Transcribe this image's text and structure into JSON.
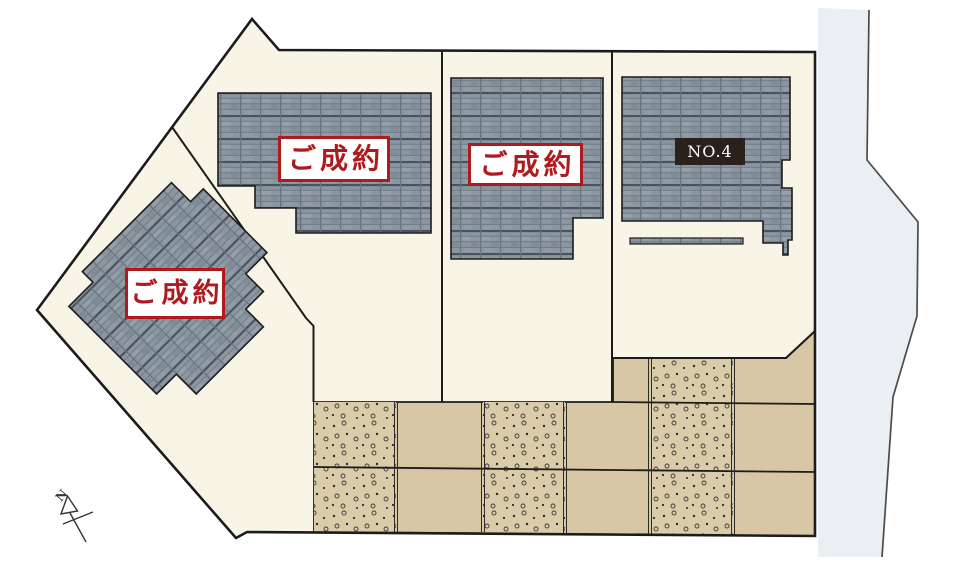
{
  "site_plan": {
    "lots": [
      {
        "id": "lot-1",
        "label": "ご成約"
      },
      {
        "id": "lot-2",
        "label": "ご成約"
      },
      {
        "id": "lot-3",
        "label": "ご成約"
      },
      {
        "id": "lot-4",
        "label": "NO.4"
      }
    ],
    "compass": {
      "label": "N"
    },
    "colors": {
      "site_fill": "#F8F5E6",
      "roof_gray": "#8B96A1",
      "parking_tan": "#D7C7A4",
      "stall_stipple_tan": "#DACBA9",
      "road_gray": "#EAEFF4",
      "accent_red": "#AF1A1F",
      "available_badge_bg": "#2A211B",
      "outline": "#1C1C1C"
    }
  }
}
